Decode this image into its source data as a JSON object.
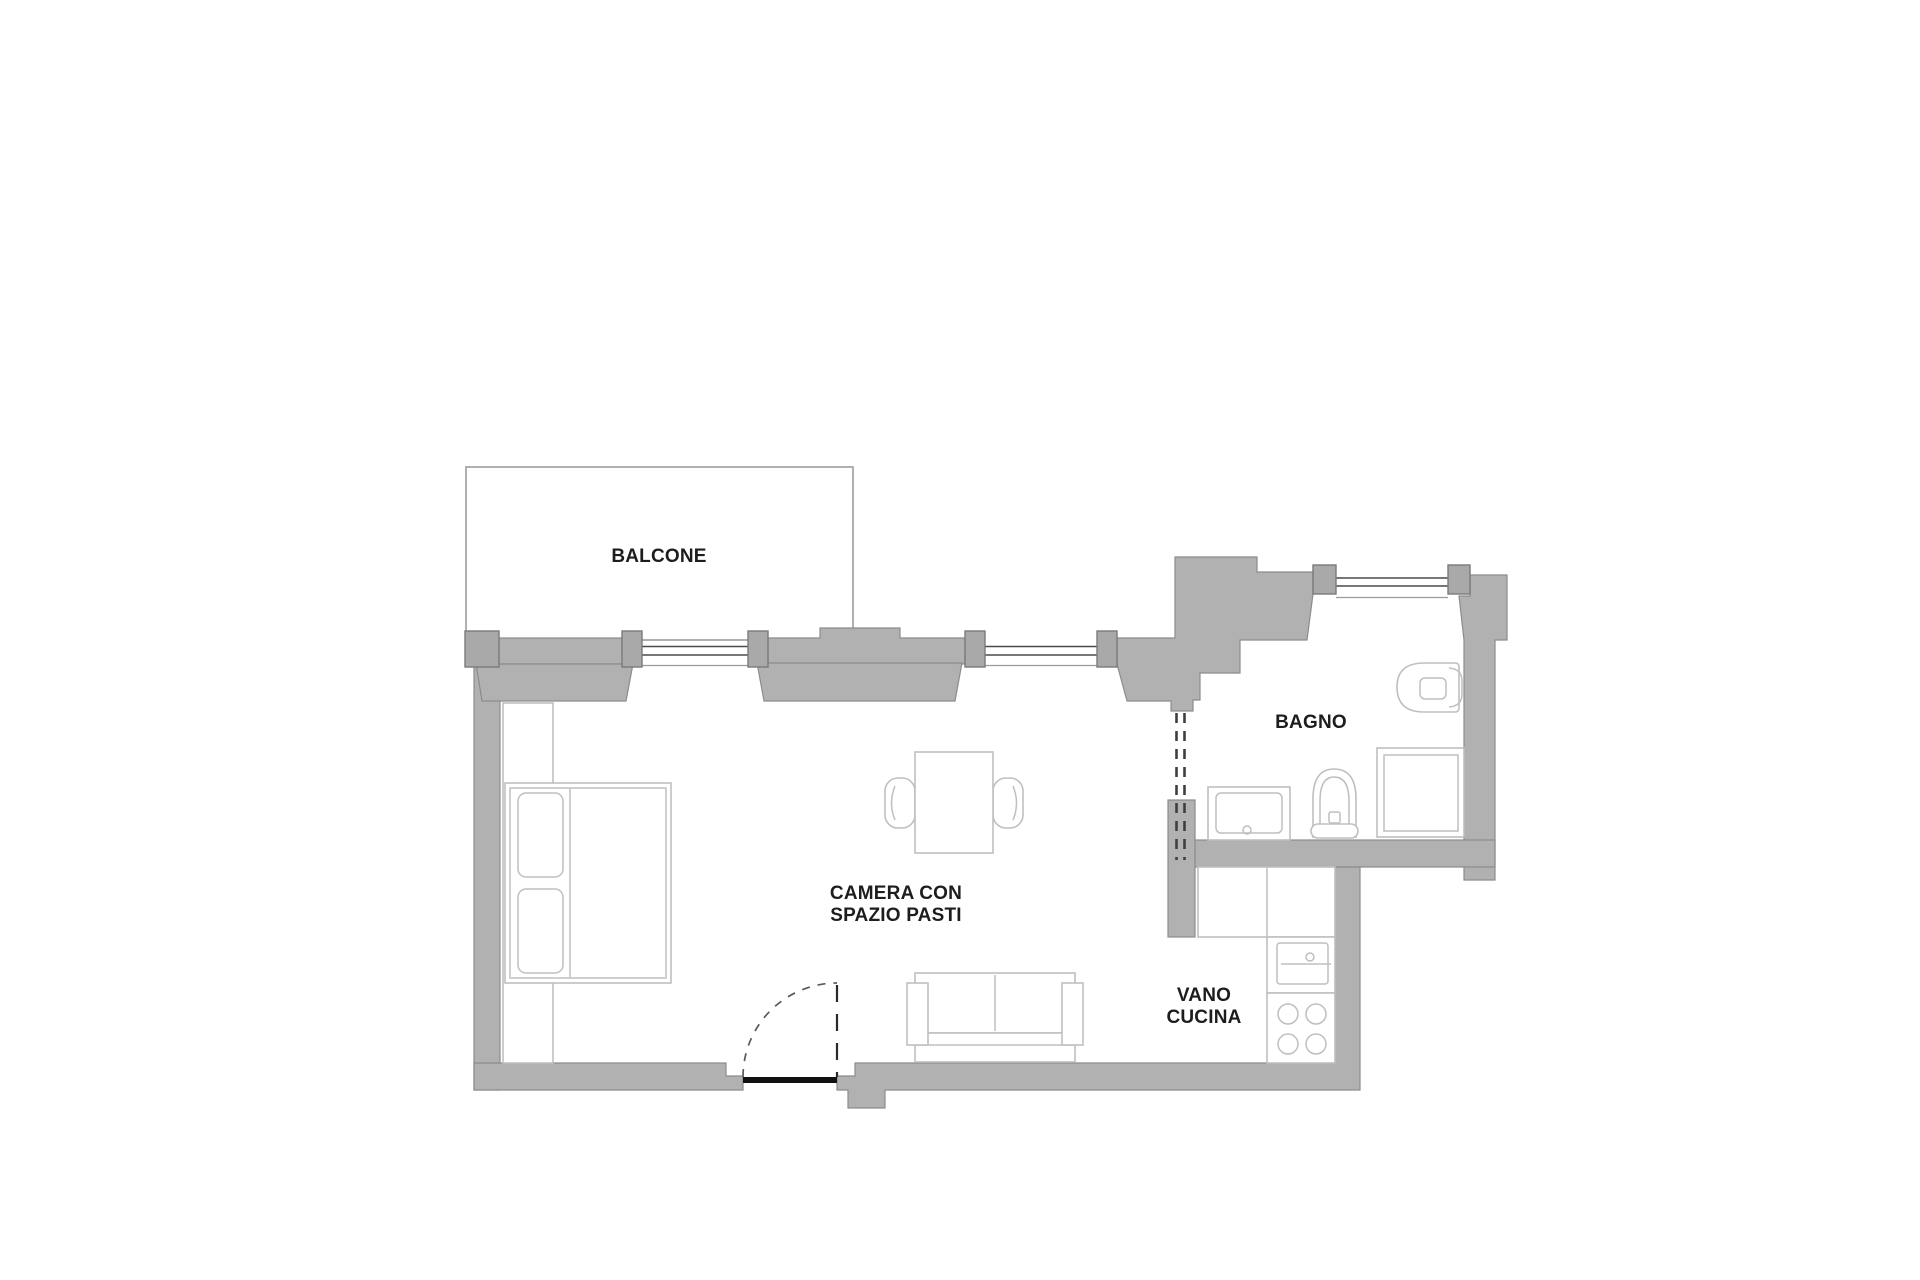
{
  "colors": {
    "wall_fill": "#b1b1b1",
    "wall_stroke": "#8c8c8c",
    "pillar_fill": "#a9a9a9",
    "pillar_stroke": "#7a7a7a",
    "fixture_stroke": "#bfbfbf",
    "balcony_stroke": "#9c9c9c",
    "label_color": "#1d1d1d",
    "window_glass": "#4a4a4a",
    "window_face": "#9a9a9a",
    "door_dash": "#3f3f3f",
    "door_arc": "#5a5a5a",
    "threshold_color": "#101010"
  },
  "rooms": {
    "balcone": {
      "label": "BALCONE"
    },
    "camera": {
      "label_line1": "CAMERA CON",
      "label_line2": "SPAZIO PASTI"
    },
    "bagno": {
      "label": "BAGNO"
    },
    "vano_cucina": {
      "label_line1": "VANO",
      "label_line2": "CUCINA"
    }
  }
}
